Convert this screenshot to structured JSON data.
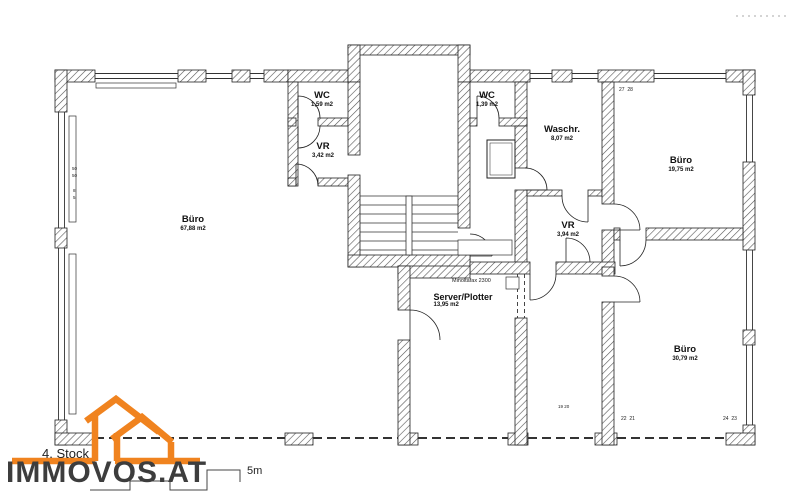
{
  "plan": {
    "floor_label": "4. Stock",
    "rooms": [
      {
        "id": "buero-left",
        "name": "Büro",
        "area": "67,88 m2"
      },
      {
        "id": "wc-left",
        "name": "WC",
        "area": "1,59 m2"
      },
      {
        "id": "vr-left",
        "name": "VR",
        "area": "3,42 m2"
      },
      {
        "id": "wc-right",
        "name": "WC",
        "area": "1,39 m2"
      },
      {
        "id": "waschraum",
        "name": "Waschr.",
        "area": "8,07 m2"
      },
      {
        "id": "buero-top-right",
        "name": "Büro",
        "area": "19,75 m2"
      },
      {
        "id": "vr-right",
        "name": "VR",
        "area": "3,94 m2"
      },
      {
        "id": "server-plotter",
        "name": "Server/Plotter",
        "area": "13,95 m2"
      },
      {
        "id": "buero-bottom-right",
        "name": "Büro",
        "area": "30,79 m2"
      }
    ],
    "fax_label": "Minoltafax 2300",
    "dims": [
      {
        "id": "top-right",
        "text": "27  28"
      },
      {
        "id": "bottom-mid",
        "text": "22  21"
      },
      {
        "id": "bottom-right",
        "text": "24  23"
      },
      {
        "id": "bottom-small",
        "text": "19 20"
      }
    ],
    "left_dims": [
      "50",
      "50",
      "8",
      "5"
    ]
  },
  "branding": {
    "logo_text": "IMMOVOS.AT",
    "orange": "#F0831F",
    "logo_text_color": "#3D3D3D"
  },
  "scale": {
    "label": "5m"
  }
}
